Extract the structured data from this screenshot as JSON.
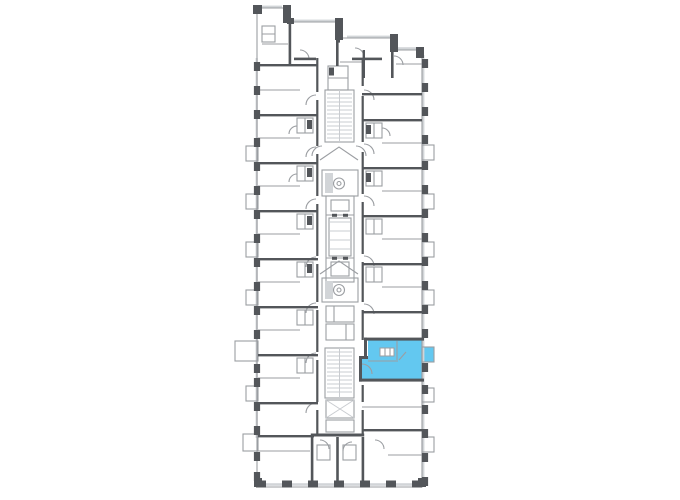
{
  "page": {
    "background_color": "#ffffff"
  },
  "colors": {
    "wall": "#53565a",
    "partition": "#9b9ea2",
    "light_detail": "#cfd2d5",
    "highlight_fill": "#63c8f0"
  },
  "floor_plan": {
    "kind": "apartment-building-floor-plan",
    "shape": "narrow vertical slab, stepped top edge descending left-to-right, central stair-and-elevator core with corridor",
    "highlighted_apartment": {
      "name": "selected-apartment",
      "side": "right",
      "position": "lower-middle of plan",
      "fill": "#63c8f0",
      "has_balcony": true
    },
    "core": {
      "stairwells": 2,
      "elevator_lobbies": 2,
      "lobby_symbol": "circled-chute-symbol"
    },
    "balconies": {
      "left_count": 7,
      "right_count": 7
    }
  }
}
